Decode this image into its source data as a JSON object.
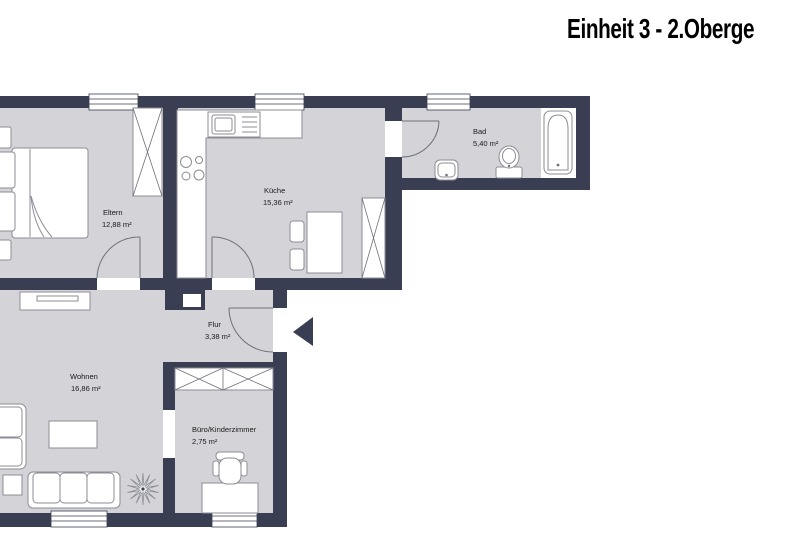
{
  "header": {
    "title": "Einheit 3 - 2.Oberge"
  },
  "rooms": [
    {
      "name": "Eltern",
      "area": "12,88 m²"
    },
    {
      "name": "Küche",
      "area": "15,36 m²"
    },
    {
      "name": "Bad",
      "area": "5,40 m²"
    },
    {
      "name": "Flur",
      "area": "3,38 m²"
    },
    {
      "name": "Wohnen",
      "area": "16,86 m²"
    },
    {
      "name": "Büro/Kinderzimmer",
      "area": "2,75 m²"
    }
  ],
  "icons": {
    "entrance_arrow": "triangle-left"
  },
  "colors": {
    "wall": "#3a3e52",
    "floor": "#d3d3d8",
    "furniture_outline": "#8c8c96",
    "door_swing": "#70707c",
    "label_text": "#1a1a1a",
    "background": "#ffffff"
  }
}
